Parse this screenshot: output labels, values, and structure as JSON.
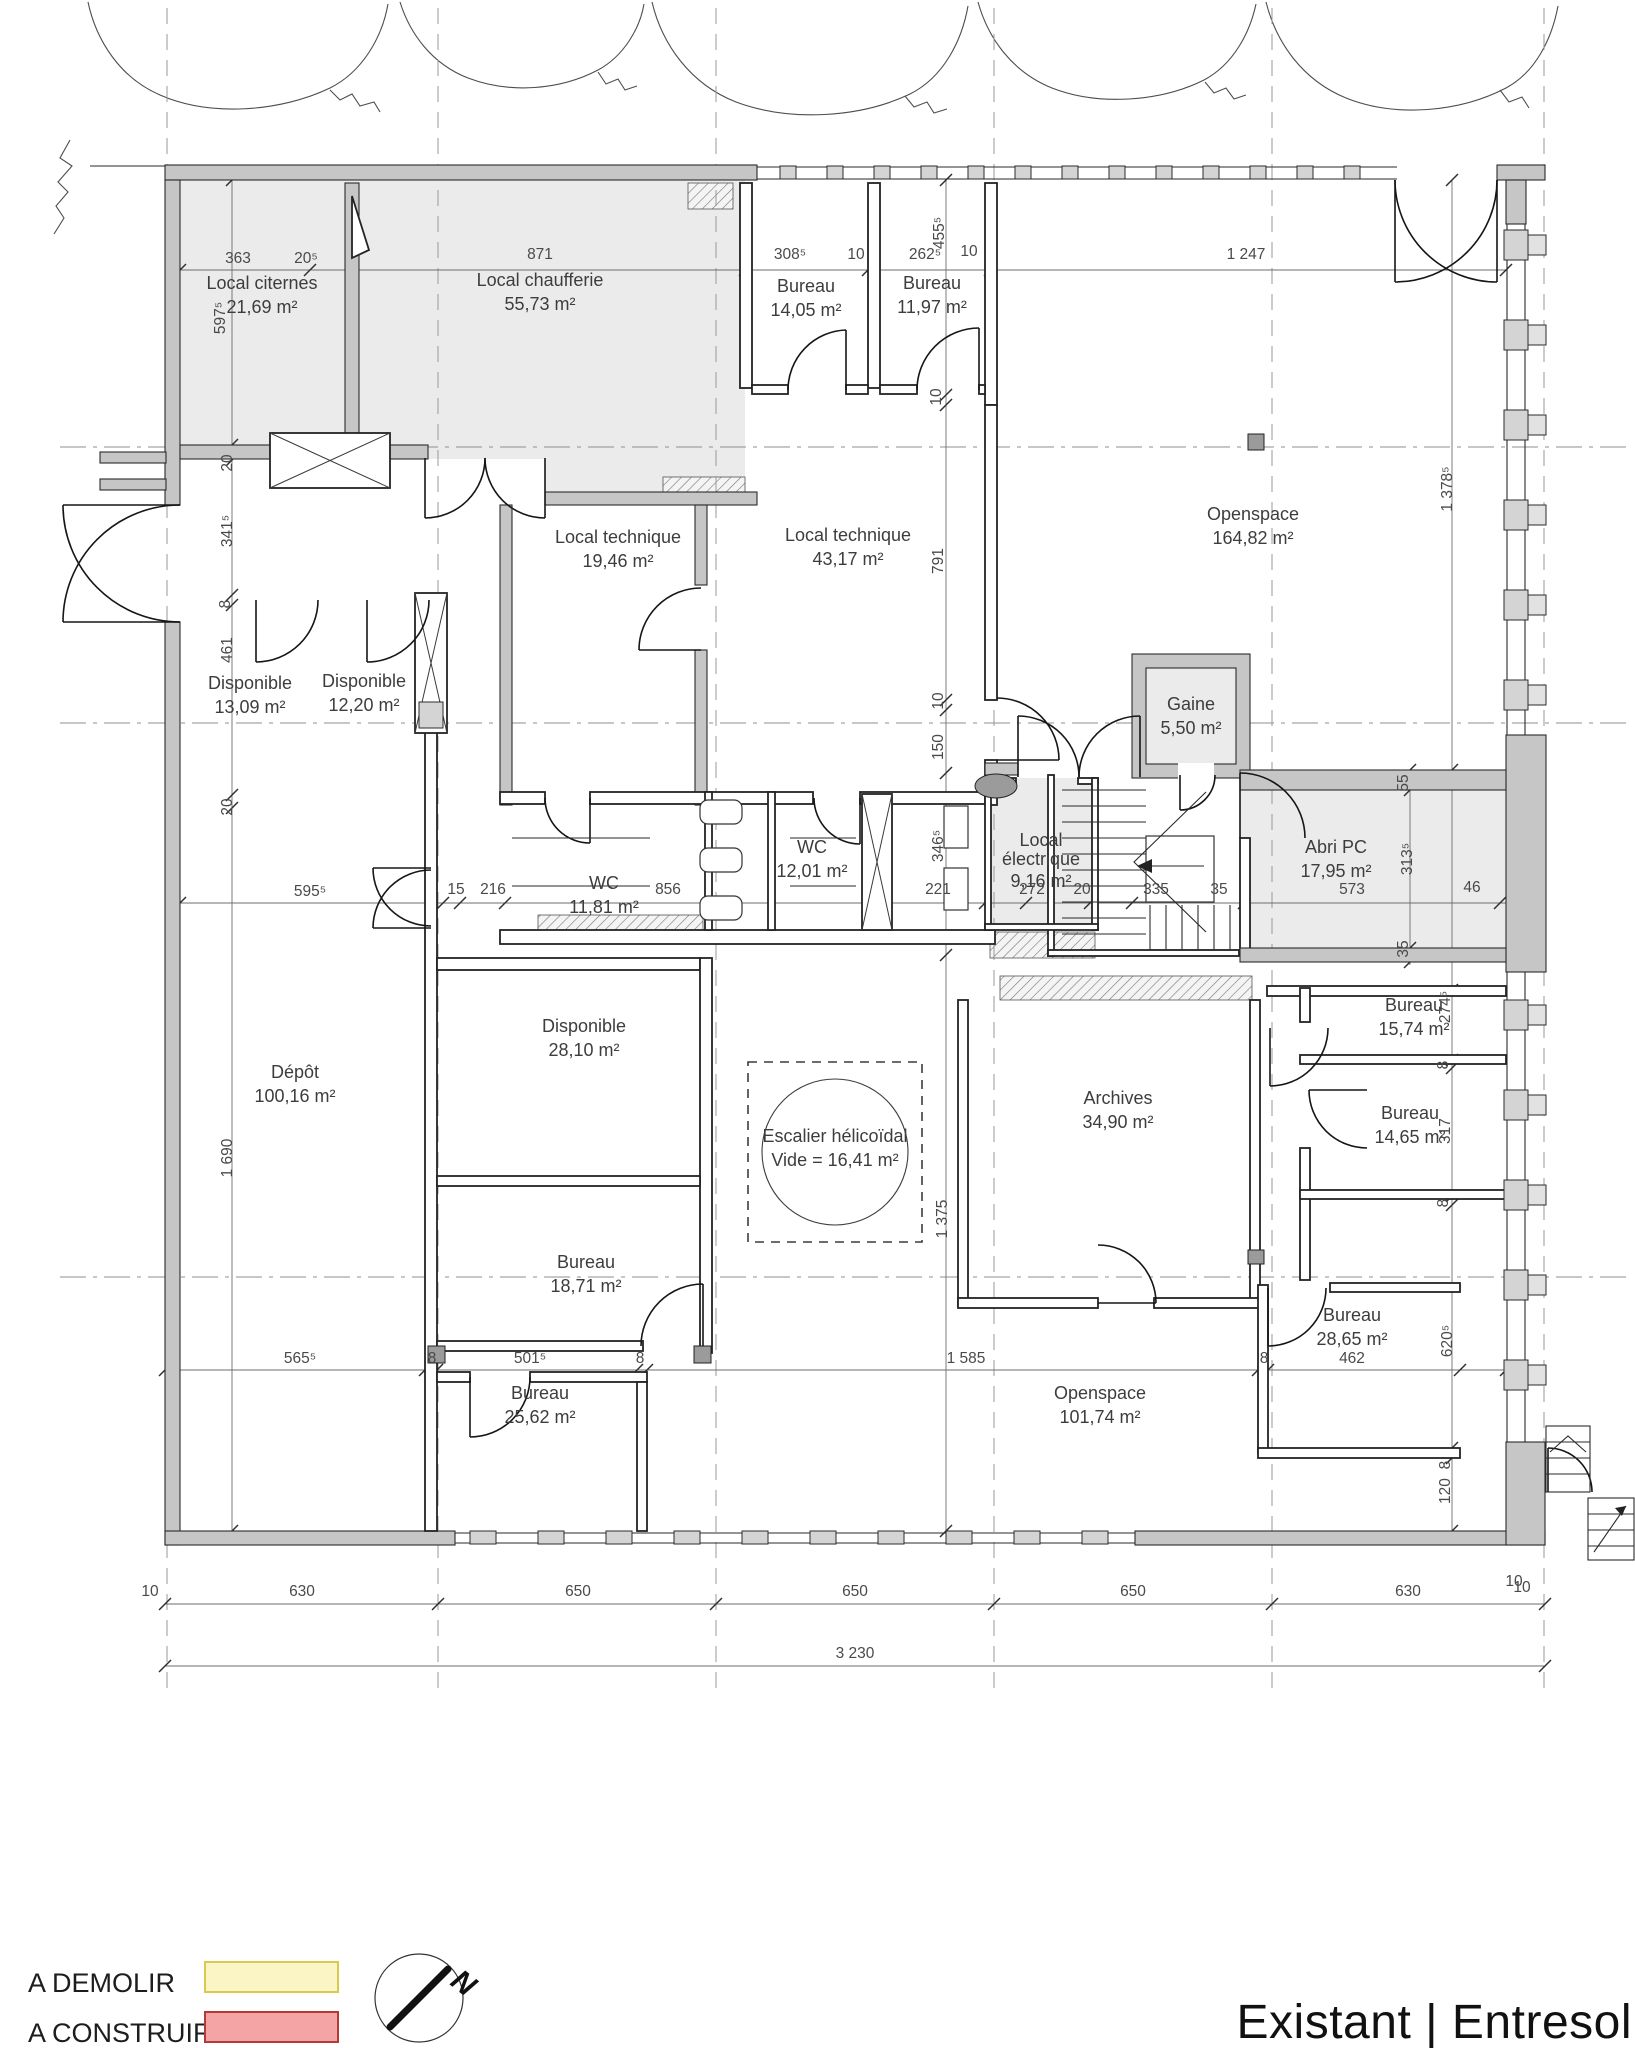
{
  "title": "Existant | Entresol",
  "legend": {
    "items": [
      {
        "label": "A DEMOLIR",
        "fill": "#fbf5c5",
        "stroke": "#d9c94f"
      },
      {
        "label": "A CONSTRUIRE",
        "fill": "#f4a4a4",
        "stroke": "#b03b38"
      }
    ]
  },
  "compass": {
    "label": "N"
  },
  "rooms": [
    {
      "id": "local-citernes",
      "name": "Local citernes",
      "area": "21,69 m²",
      "x": 262,
      "y": 289
    },
    {
      "id": "local-chaufferie",
      "name": "Local chaufferie",
      "area": "55,73 m²",
      "x": 540,
      "y": 286
    },
    {
      "id": "bureau-a",
      "name": "Bureau",
      "area": "14,05 m²",
      "x": 806,
      "y": 292
    },
    {
      "id": "bureau-b",
      "name": "Bureau",
      "area": "11,97 m²",
      "x": 932,
      "y": 289
    },
    {
      "id": "openspace-a",
      "name": "Openspace",
      "area": "164,82 m²",
      "x": 1253,
      "y": 520
    },
    {
      "id": "local-technique-a",
      "name": "Local technique",
      "area": "19,46 m²",
      "x": 618,
      "y": 543
    },
    {
      "id": "local-technique-b",
      "name": "Local technique",
      "area": "43,17 m²",
      "x": 848,
      "y": 541
    },
    {
      "id": "disponible-a",
      "name": "Disponible",
      "area": "13,09 m²",
      "x": 250,
      "y": 689
    },
    {
      "id": "disponible-b",
      "name": "Disponible",
      "area": "12,20 m²",
      "x": 364,
      "y": 687
    },
    {
      "id": "gaine",
      "name": "Gaine",
      "area": "5,50 m²",
      "x": 1191,
      "y": 710
    },
    {
      "id": "wc-a",
      "name": "WC",
      "area": "12,01 m²",
      "x": 812,
      "y": 853
    },
    {
      "id": "wc-b",
      "name": "WC",
      "area": "11,81 m²",
      "x": 604,
      "y": 889
    },
    {
      "id": "local-electrique",
      "name": "Local",
      "name2": "électrique",
      "area": "9,16 m²",
      "x": 1041,
      "y": 846
    },
    {
      "id": "abri-pc",
      "name": "Abri PC",
      "area": "17,95 m²",
      "x": 1336,
      "y": 853
    },
    {
      "id": "disponible-c",
      "name": "Disponible",
      "area": "28,10 m²",
      "x": 584,
      "y": 1032
    },
    {
      "id": "depot",
      "name": "Dépôt",
      "area": "100,16 m²",
      "x": 295,
      "y": 1078
    },
    {
      "id": "escalier",
      "name": "Escalier hélicoïdal",
      "area": "Vide = 16,41 m²",
      "x": 835,
      "y": 1142
    },
    {
      "id": "bureau-c",
      "name": "Bureau",
      "area": "18,71 m²",
      "x": 586,
      "y": 1268
    },
    {
      "id": "archives",
      "name": "Archives",
      "area": "34,90 m²",
      "x": 1118,
      "y": 1104
    },
    {
      "id": "bureau-d",
      "name": "Bureau",
      "area": "15,74 m²",
      "x": 1414,
      "y": 1011
    },
    {
      "id": "bureau-e",
      "name": "Bureau",
      "area": "14,65 m²",
      "x": 1410,
      "y": 1119
    },
    {
      "id": "bureau-f",
      "name": "Bureau",
      "area": "28,65 m²",
      "x": 1352,
      "y": 1321
    },
    {
      "id": "bureau-g",
      "name": "Bureau",
      "area": "25,62 m²",
      "x": 540,
      "y": 1399
    },
    {
      "id": "openspace-b",
      "name": "Openspace",
      "area": "101,74 m²",
      "x": 1100,
      "y": 1399
    }
  ],
  "dims": [
    {
      "t": "363",
      "x": 238,
      "y": 263
    },
    {
      "t": "20⁵",
      "x": 306,
      "y": 263
    },
    {
      "t": "871",
      "x": 540,
      "y": 259
    },
    {
      "t": "308⁵",
      "x": 790,
      "y": 259
    },
    {
      "t": "10",
      "x": 856,
      "y": 259
    },
    {
      "t": "262⁵",
      "x": 925,
      "y": 259
    },
    {
      "t": "10",
      "x": 969,
      "y": 256
    },
    {
      "t": "1 247",
      "x": 1246,
      "y": 259
    },
    {
      "t": "595⁵",
      "x": 310,
      "y": 896
    },
    {
      "t": "15",
      "x": 456,
      "y": 894
    },
    {
      "t": "216",
      "x": 493,
      "y": 894
    },
    {
      "t": "856",
      "x": 668,
      "y": 894
    },
    {
      "t": "221",
      "x": 938,
      "y": 894
    },
    {
      "t": "272",
      "x": 1032,
      "y": 894
    },
    {
      "t": "20",
      "x": 1082,
      "y": 894
    },
    {
      "t": "335",
      "x": 1156,
      "y": 894
    },
    {
      "t": "35",
      "x": 1219,
      "y": 894
    },
    {
      "t": "573",
      "x": 1352,
      "y": 894
    },
    {
      "t": "46",
      "x": 1472,
      "y": 892
    },
    {
      "t": "565⁵",
      "x": 300,
      "y": 1363
    },
    {
      "t": "8",
      "x": 432,
      "y": 1363
    },
    {
      "t": "501⁵",
      "x": 530,
      "y": 1363
    },
    {
      "t": "8",
      "x": 640,
      "y": 1363
    },
    {
      "t": "1 585",
      "x": 966,
      "y": 1363
    },
    {
      "t": "8",
      "x": 1264,
      "y": 1363
    },
    {
      "t": "462",
      "x": 1352,
      "y": 1363
    },
    {
      "t": "10",
      "x": 150,
      "y": 1596
    },
    {
      "t": "630",
      "x": 302,
      "y": 1596
    },
    {
      "t": "650",
      "x": 578,
      "y": 1596
    },
    {
      "t": "650",
      "x": 855,
      "y": 1596
    },
    {
      "t": "650",
      "x": 1133,
      "y": 1596
    },
    {
      "t": "630",
      "x": 1408,
      "y": 1596
    },
    {
      "t": "10",
      "x": 1522,
      "y": 1592
    },
    {
      "t": "3 230",
      "x": 855,
      "y": 1658
    },
    {
      "t": "10",
      "x": 1514,
      "y": 1586
    },
    {
      "t": "597⁵",
      "x": 225,
      "y": 318,
      "v": 1
    },
    {
      "t": "20",
      "x": 232,
      "y": 463,
      "v": 1
    },
    {
      "t": "341⁵",
      "x": 232,
      "y": 531,
      "v": 1
    },
    {
      "t": "8",
      "x": 230,
      "y": 604,
      "v": 1
    },
    {
      "t": "461",
      "x": 232,
      "y": 650,
      "v": 1
    },
    {
      "t": "20",
      "x": 232,
      "y": 807,
      "v": 1
    },
    {
      "t": "1 690",
      "x": 232,
      "y": 1158,
      "v": 1
    },
    {
      "t": "455⁵",
      "x": 944,
      "y": 233,
      "v": 1
    },
    {
      "t": "10",
      "x": 941,
      "y": 397,
      "v": 1
    },
    {
      "t": "791",
      "x": 943,
      "y": 561,
      "v": 1
    },
    {
      "t": "10",
      "x": 943,
      "y": 701,
      "v": 1
    },
    {
      "t": "150",
      "x": 943,
      "y": 747,
      "v": 1
    },
    {
      "t": "346⁵",
      "x": 943,
      "y": 846,
      "v": 1
    },
    {
      "t": "1 375",
      "x": 947,
      "y": 1219,
      "v": 1
    },
    {
      "t": "55",
      "x": 1408,
      "y": 783,
      "v": 1
    },
    {
      "t": "313⁵",
      "x": 1412,
      "y": 859,
      "v": 1
    },
    {
      "t": "35",
      "x": 1408,
      "y": 949,
      "v": 1
    },
    {
      "t": "1 378⁵",
      "x": 1452,
      "y": 489,
      "v": 1
    },
    {
      "t": "274⁵",
      "x": 1450,
      "y": 1007,
      "v": 1
    },
    {
      "t": "8",
      "x": 1448,
      "y": 1065,
      "v": 1
    },
    {
      "t": "317",
      "x": 1450,
      "y": 1131,
      "v": 1
    },
    {
      "t": "8",
      "x": 1448,
      "y": 1203,
      "v": 1
    },
    {
      "t": "620⁵",
      "x": 1452,
      "y": 1341,
      "v": 1
    },
    {
      "t": "8",
      "x": 1450,
      "y": 1465,
      "v": 1
    },
    {
      "t": "120",
      "x": 1450,
      "y": 1491,
      "v": 1
    }
  ]
}
